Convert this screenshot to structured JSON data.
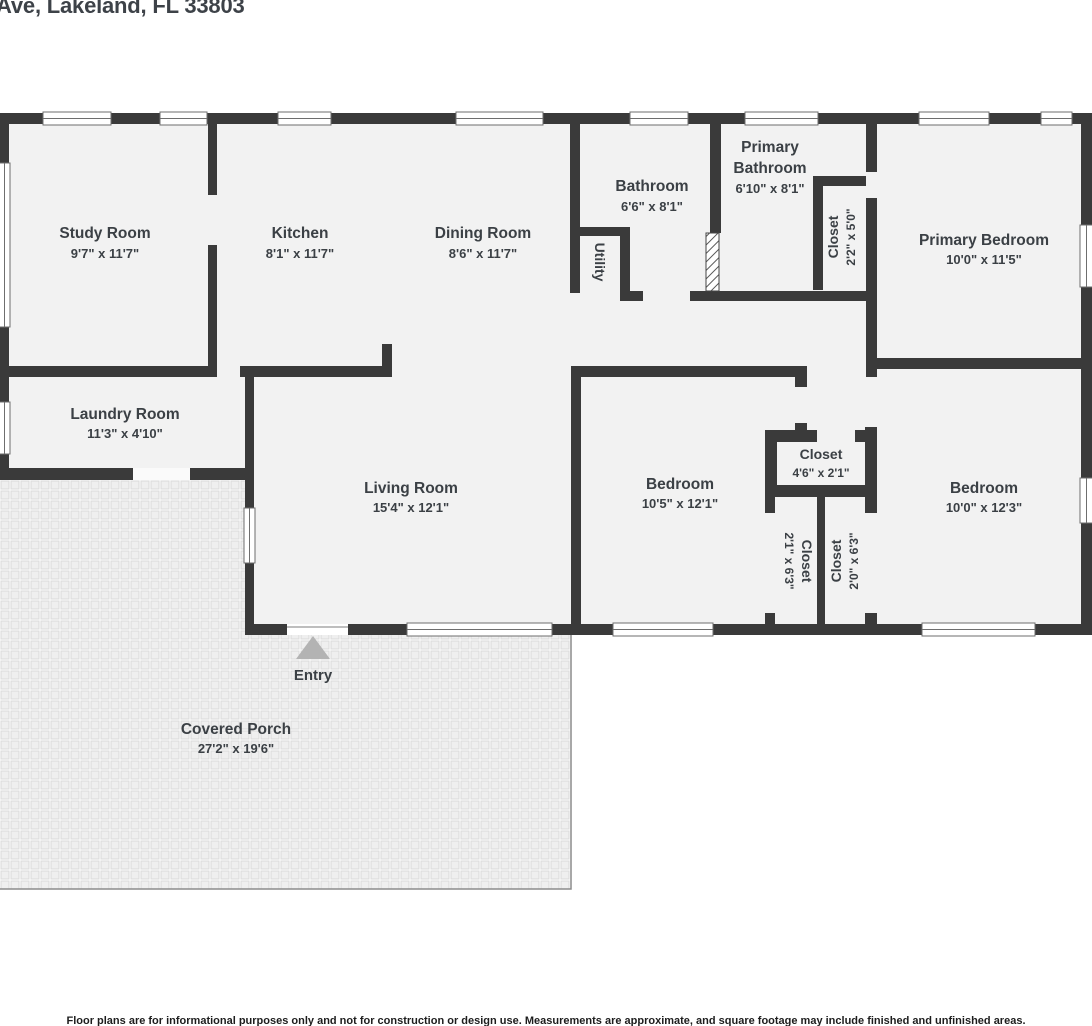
{
  "title": "Ave, Lakeland, FL 33803",
  "disclaimer": "Floor plans are for informational purposes only and not for construction or design use. Measurements are approximate, and square footage may include finished and unfinished areas.",
  "entry": {
    "label": "Entry"
  },
  "rooms": {
    "study": {
      "name": "Study Room",
      "dims": "9'7\" x 11'7\""
    },
    "kitchen": {
      "name": "Kitchen",
      "dims": "8'1\" x 11'7\""
    },
    "dining": {
      "name": "Dining Room",
      "dims": "8'6\" x 11'7\""
    },
    "bathroom": {
      "name": "Bathroom",
      "dims": "6'6\" x 8'1\""
    },
    "utility": {
      "name": "Utility"
    },
    "primary_bathroom": {
      "name_line1": "Primary",
      "name_line2": "Bathroom",
      "dims": "6'10\" x 8'1\""
    },
    "closet_primary": {
      "name": "Closet",
      "dims": "2'2\" x 5'0\""
    },
    "primary_bedroom": {
      "name": "Primary Bedroom",
      "dims": "10'0\" x 11'5\""
    },
    "laundry": {
      "name": "Laundry Room",
      "dims": "11'3\" x 4'10\""
    },
    "living": {
      "name": "Living Room",
      "dims": "15'4\" x 12'1\""
    },
    "bedroom_middle": {
      "name": "Bedroom",
      "dims": "10'5\" x 12'1\""
    },
    "closet_hall": {
      "name": "Closet",
      "dims": "4'6\" x 2'1\""
    },
    "closet_left": {
      "name": "Closet",
      "dims": "2'1\" x 6'3\""
    },
    "closet_right": {
      "name": "Closet",
      "dims": "2'0\" x 6'3\""
    },
    "bedroom_right": {
      "name": "Bedroom",
      "dims": "10'0\" x 12'3\""
    },
    "porch": {
      "name": "Covered Porch",
      "dims": "27'2\" x 19'6\""
    }
  },
  "colors": {
    "wall": "#3a3a3a",
    "room_fill": "#f2f2f2",
    "label_text": "#3b4045",
    "entry_arrow": "#b3b3b3",
    "porch_tile": "#efefef",
    "window_frame": "#6e6e6e"
  }
}
